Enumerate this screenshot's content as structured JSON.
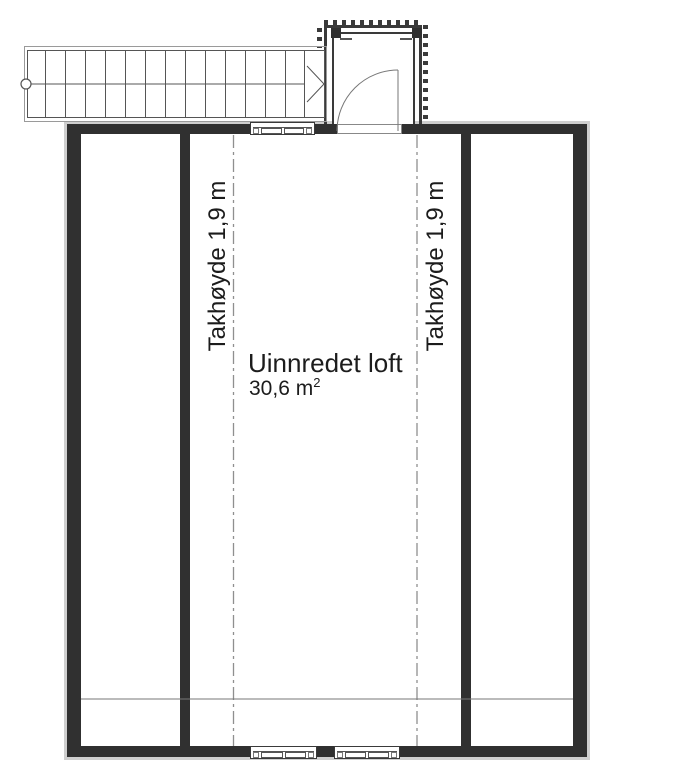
{
  "floorplan": {
    "room_label": "Uinnredet loft",
    "room_area_value": "30,6 m",
    "room_area_exponent": "2",
    "ceiling_height_left": "Takhøyde 1,9 m",
    "ceiling_height_right": "Takhøyde 1,9 m"
  },
  "stair": {
    "tread_count": 14,
    "direction_arrow": "right"
  },
  "colors": {
    "wall": "#303030",
    "line": "#555555",
    "thin_line": "#777777",
    "dash_line": "#8f8f8f",
    "halo": "#cfcfcf",
    "text": "#1c1c1c",
    "background": "#ffffff"
  }
}
